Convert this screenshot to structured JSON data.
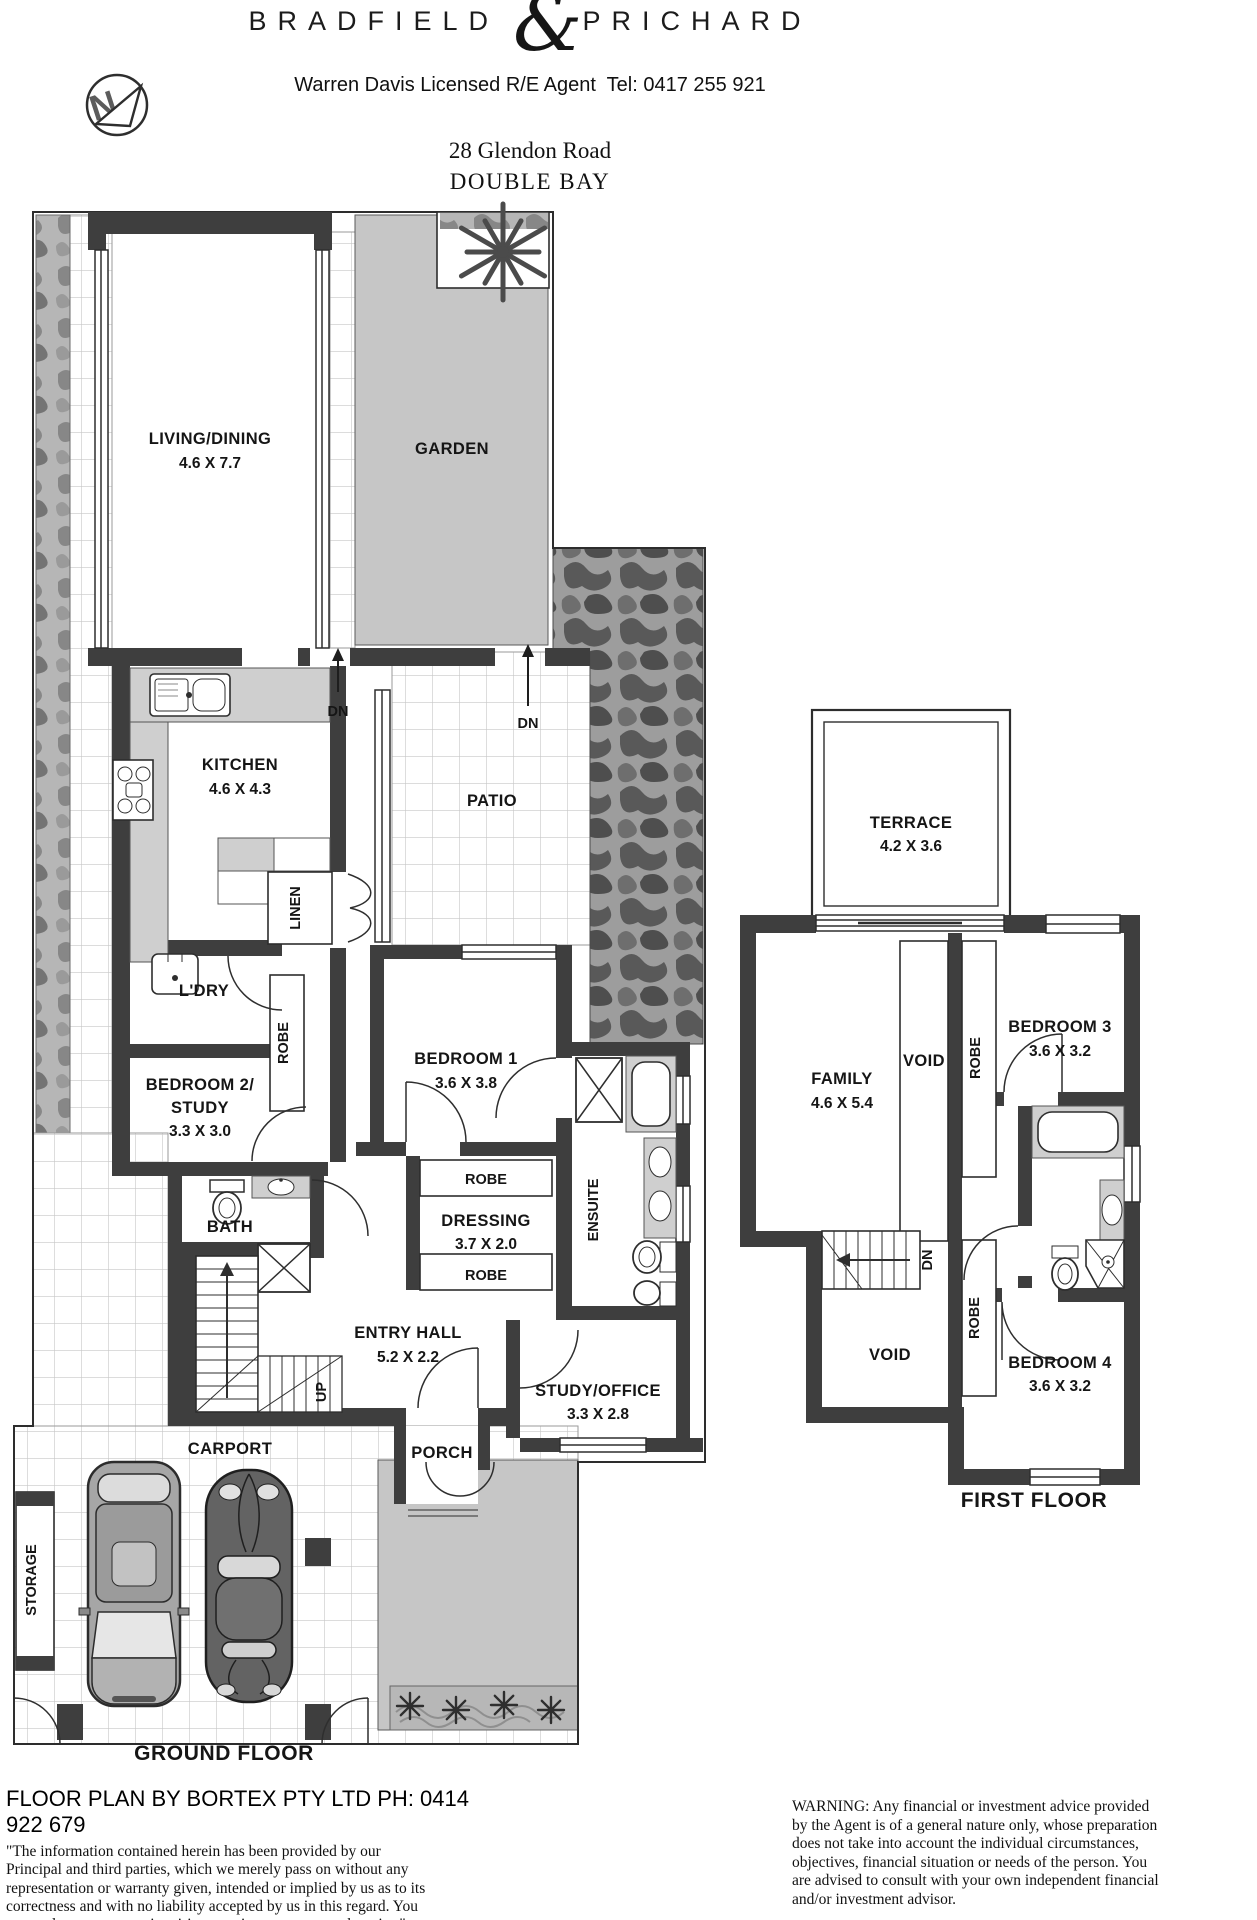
{
  "header": {
    "brand_first": "BRADFIELD",
    "brand_ampersand": "&",
    "brand_second": "PRICHARD",
    "agent_line": "Warren Davis Licensed R/E Agent  Tel: 0417 255 921",
    "address_line1": "28 Glendon Road",
    "address_line2": "DOUBLE BAY",
    "compass_letter": "N"
  },
  "ground_floor": {
    "title": "GROUND FLOOR",
    "living": {
      "name": "LIVING/DINING",
      "dims": "4.6 X 7.7"
    },
    "garden": "GARDEN",
    "kitchen": {
      "name": "KITCHEN",
      "dims": "4.6 X 4.3"
    },
    "dn_kitchen": "DN",
    "dn_patio": "DN",
    "patio": "PATIO",
    "linen": "LINEN",
    "laundry": "L'DRY",
    "bedroom2": {
      "line1": "BEDROOM 2/",
      "line2": "STUDY",
      "dims": "3.3 X 3.0"
    },
    "robe_bedroom2": "ROBE",
    "bedroom1": {
      "name": "BEDROOM 1",
      "dims": "3.6 X 3.8"
    },
    "robe_upper": "ROBE",
    "dressing": {
      "name": "DRESSING",
      "dims": "3.7 X 2.0"
    },
    "robe_lower": "ROBE",
    "ensuite": "ENSUITE",
    "bath": "BATH",
    "entry_hall": {
      "name": "ENTRY HALL",
      "dims": "5.2 X 2.2"
    },
    "up": "UP",
    "study_office": {
      "name": "STUDY/OFFICE",
      "dims": "3.3 X 2.8"
    },
    "porch": "PORCH",
    "carport": "CARPORT",
    "storage": "STORAGE"
  },
  "first_floor": {
    "title": "FIRST FLOOR",
    "terrace": {
      "name": "TERRACE",
      "dims": "4.2 X 3.6"
    },
    "family": {
      "name": "FAMILY",
      "dims": "4.6 X 5.4"
    },
    "void_upper": "VOID",
    "robe_bedroom3": "ROBE",
    "bedroom3": {
      "name": "BEDROOM 3",
      "dims": "3.6 X 3.2"
    },
    "dn": "DN",
    "void_lower": "VOID",
    "robe_bedroom4": "ROBE",
    "bedroom4": {
      "name": "BEDROOM 4",
      "dims": "3.6 X 3.2"
    }
  },
  "footer": {
    "credit": "FLOOR PLAN BY BORTEX PTY LTD PH: 0414 922 679",
    "disclaimer": "\"The information contained herein has been provided by our Principal and third parties, which we merely pass on without any representation or warranty given, intended or implied by us as to its correctness and with no liability accepted by us in this regard. You must rely on your own inquiries as to its accuracy or otherwise.\"",
    "warning": "WARNING: Any financial or investment advice provided by the Agent is of a general nature only, whose preparation does not take into account the individual circumstances, objectives, financial situation or needs of the person. You are advised to consult with your own independent financial and/or investment advisor."
  },
  "colors": {
    "wall": "#3e3e3e",
    "paving": "#c6c6c6",
    "ink": "#151515"
  }
}
